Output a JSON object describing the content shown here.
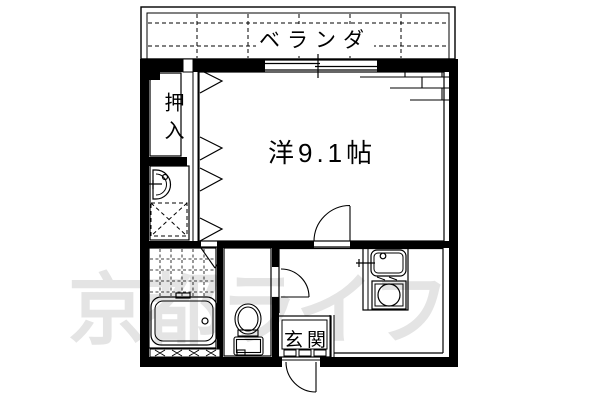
{
  "floorplan": {
    "labels": {
      "veranda": "ベランダ",
      "closet": "押入",
      "main_room": "洋9.1帖",
      "entrance": "玄関"
    },
    "watermark": "京都ライフ",
    "colors": {
      "line": "#000000",
      "background": "#ffffff",
      "watermark": "#e4e4e4"
    },
    "fixtures": [
      "bathtub-icon",
      "toilet-icon",
      "washbasin-icon",
      "washing-machine-space-icon",
      "kitchen-sink-icon",
      "stove-burner-icon",
      "sliding-window-icon",
      "folding-door-icon",
      "door-swing-icon"
    ]
  }
}
